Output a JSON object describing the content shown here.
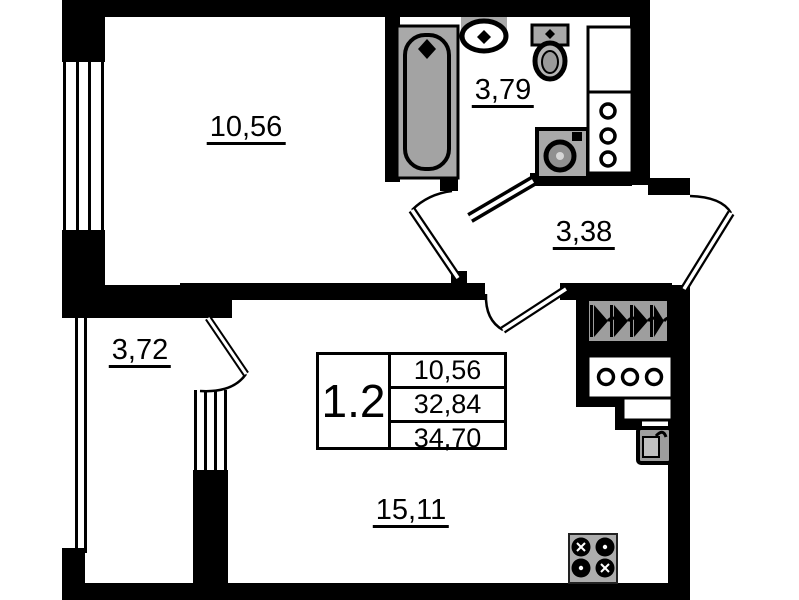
{
  "plan_title": "apartment floor plan 1.2",
  "info_table": {
    "unit_number": "1.2",
    "rows": [
      "10,56",
      "32,84",
      "34,70"
    ]
  },
  "rooms": {
    "bedroom": {
      "area": "10,56"
    },
    "bathroom": {
      "area": "3,79"
    },
    "hallway": {
      "area": "3,38"
    },
    "balcony": {
      "area": "3,72"
    },
    "living_kitchen": {
      "area": "15,11"
    }
  },
  "icons": [
    "bathtub-icon",
    "sink-icon",
    "toilet-icon",
    "washing-machine-icon",
    "shaft-circles-icon",
    "wardrobe-hangers-icon",
    "stove-icon",
    "water-heater-icon",
    "window-icon",
    "door-swing-icon"
  ],
  "colors": {
    "wall": "#000000",
    "fixture": "#a9a9a9",
    "background": "#ffffff"
  }
}
